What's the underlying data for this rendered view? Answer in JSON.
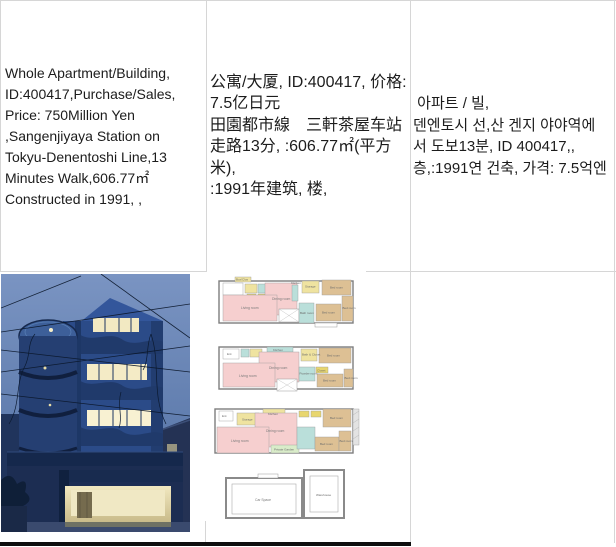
{
  "listing": {
    "id": "400417",
    "en": {
      "lines": [
        "Whole Apartment/Building,",
        "ID:400417,Purchase/Sales,",
        "Price: 750Million Yen",
        ",Sangenjiyaya Station on",
        "Tokyu-Denentoshi Line,13",
        "Minutes Walk,606.77㎡",
        "Constructed in 1991, ,"
      ]
    },
    "zh": {
      "lines": [
        "公寓/大厦, ID:400417, 价格:",
        "7.5亿日元",
        "田園都市線　三軒茶屋车站",
        "走路13分, :606.77㎡(平方米),",
        ":1991年建筑, 楼,"
      ]
    },
    "ko": {
      "lines": [
        " 아파트 / 빌,",
        "덴엔토시 선,산 겐지 야야역에",
        "서 도보13분, ID 400417,,",
        "층,:1991연 건축, 가격: 7.5억엔"
      ]
    }
  },
  "floorplans": {
    "plan1": {
      "box": "Box/Clos",
      "living": "Living room",
      "dining": "Dining room",
      "kitchen": "Kitchen",
      "storage": "Storage",
      "bath": "Bath room",
      "bed1": "Bed room",
      "bed2": "Bed room",
      "bed3": "Bed room"
    },
    "plan2": {
      "ent": "Ent",
      "kitchen": "Kitchen",
      "living": "Living room",
      "dining": "Dining room",
      "bathcloset": "Bath & Closet",
      "powder": "Powder room",
      "closet": "Closet",
      "bed1": "Bed room",
      "bed2": "Bed room",
      "bed3": "Bed room"
    },
    "plan3": {
      "ent": "Ent",
      "storage": "Storage",
      "kitchen": "Kitchen",
      "living": "Living room",
      "dining": "Dining room",
      "garden": "Private Garden",
      "bed1": "Bed room",
      "bed2": "Bed room",
      "bed3": "Bed room"
    },
    "plan4": {
      "car": "Car Space",
      "warehouse": "Warehouse"
    }
  },
  "colors": {
    "border": "#d6d6d6",
    "next_row_bar": "#0e0e0e",
    "room_pink": "#f6cfcf",
    "room_tan": "#ddc094",
    "room_yellow": "#efe3a0",
    "room_cyan": "#badfda",
    "room_green": "#d9ecc9"
  }
}
